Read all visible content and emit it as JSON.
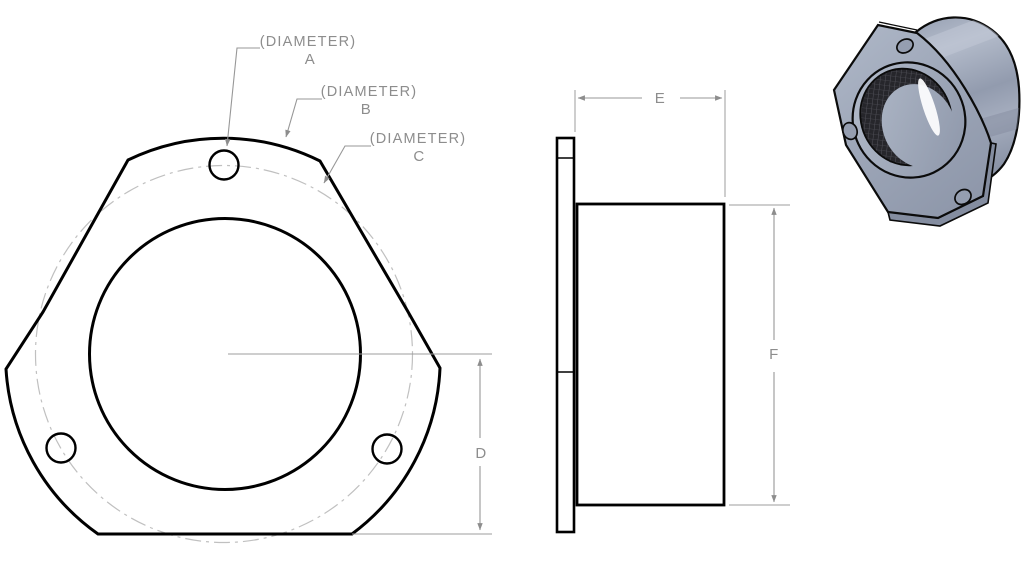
{
  "drawing": {
    "kind": "cad-part-drawing",
    "part_description": "Three-hole triangular flange with cylindrical boss",
    "views": {
      "front": "front-view",
      "side": "side-view",
      "isometric": "isometric-render"
    },
    "labels": {
      "diameter_a": {
        "line1": "(DIAMETER)",
        "line2": "A"
      },
      "diameter_b": {
        "line1": "(DIAMETER)",
        "line2": "B"
      },
      "diameter_c": {
        "line1": "(DIAMETER)",
        "line2": "C"
      },
      "dim_d": "D",
      "dim_e": "E",
      "dim_f": "F"
    },
    "colors": {
      "background": "#ffffff",
      "outline_black": "#000000",
      "dimension_gray": "#8d8d8d",
      "bolt_circle_gray": "#c0c0c0",
      "part_body": "#9aa3b5",
      "part_highlight": "#b6becd",
      "part_shadow": "#8a93a6",
      "bore_knurl_dark": "#26262b"
    }
  }
}
